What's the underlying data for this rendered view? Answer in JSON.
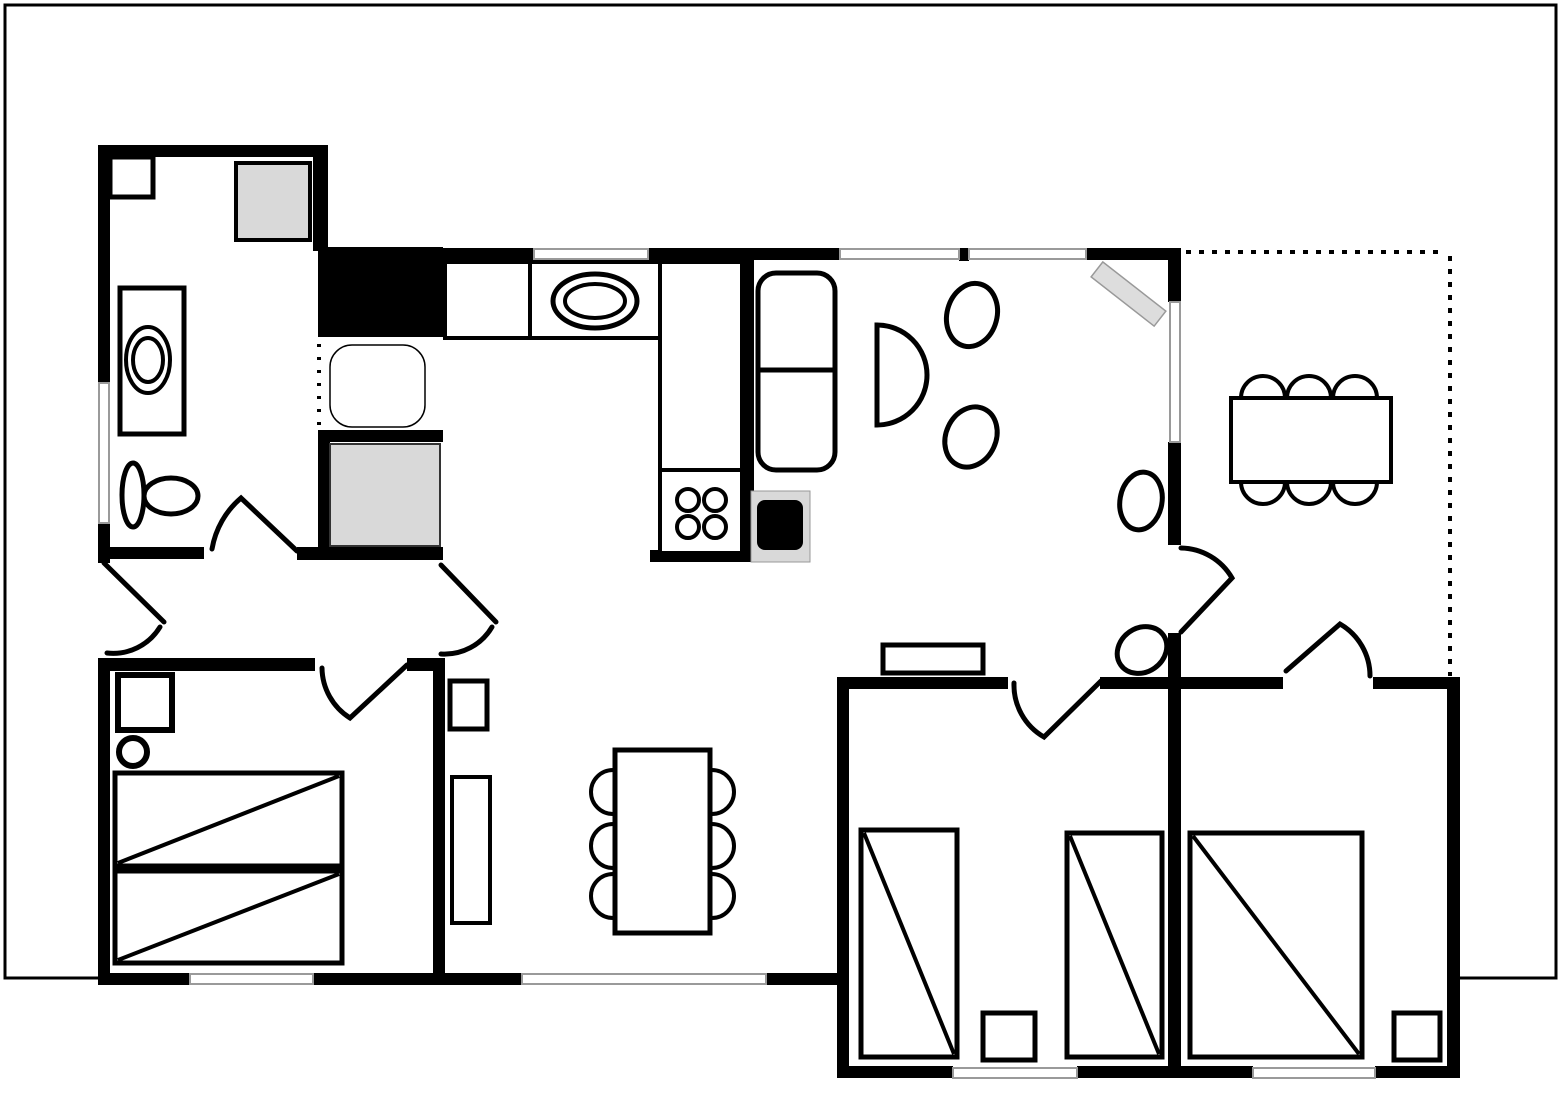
{
  "floorplan": {
    "canvas": {
      "width": 1562,
      "height": 1095,
      "background": "#ffffff"
    },
    "colors": {
      "wall": "#000000",
      "window": "#9a9a9a",
      "appliance_gray": "#d9d9d9",
      "shelf_gray": "#dddddd"
    },
    "frame": {
      "x": 5,
      "y": 5,
      "w": 1551,
      "h": 973,
      "stroke": 3
    },
    "rooms": [
      "bathroom",
      "kitchen",
      "living-room",
      "hall",
      "terrace",
      "bedroom-1",
      "bedroom-2",
      "bedroom-3"
    ],
    "interiors": [
      [
        849,
        689,
        598,
        377
      ]
    ],
    "walls": [
      [
        98,
        145,
        230,
        12
      ],
      [
        98,
        145,
        12,
        240
      ],
      [
        98,
        523,
        12,
        40
      ],
      [
        313,
        145,
        15,
        106
      ],
      [
        98,
        547,
        106,
        12
      ],
      [
        297,
        547,
        146,
        13
      ],
      [
        318,
        247,
        125,
        90
      ],
      [
        318,
        430,
        125,
        12
      ],
      [
        318,
        430,
        12,
        130
      ],
      [
        435,
        248,
        99,
        12
      ],
      [
        648,
        248,
        192,
        12
      ],
      [
        959,
        248,
        10,
        13
      ],
      [
        1086,
        248,
        95,
        12
      ],
      [
        1168,
        250,
        13,
        52
      ],
      [
        1168,
        442,
        13,
        103
      ],
      [
        1168,
        633,
        13,
        45
      ],
      [
        742,
        250,
        12,
        312
      ],
      [
        650,
        550,
        104,
        12
      ],
      [
        98,
        658,
        217,
        13
      ],
      [
        407,
        658,
        38,
        13
      ],
      [
        98,
        658,
        12,
        327
      ],
      [
        433,
        658,
        12,
        327
      ],
      [
        98,
        973,
        92,
        12
      ],
      [
        313,
        973,
        132,
        12
      ],
      [
        445,
        973,
        77,
        12
      ],
      [
        766,
        973,
        82,
        12
      ],
      [
        837,
        677,
        12,
        401
      ],
      [
        837,
        677,
        171,
        12
      ],
      [
        1100,
        677,
        80,
        12
      ],
      [
        1168,
        677,
        13,
        401
      ],
      [
        849,
        1066,
        104,
        12
      ],
      [
        1077,
        1066,
        91,
        12
      ],
      [
        1181,
        677,
        102,
        12
      ],
      [
        1373,
        677,
        87,
        12
      ],
      [
        1447,
        677,
        13,
        401
      ],
      [
        1181,
        1066,
        72,
        12
      ],
      [
        1375,
        1066,
        85,
        12
      ]
    ],
    "windows": [
      [
        534,
        249,
        114,
        10
      ],
      [
        840,
        249,
        119,
        10
      ],
      [
        969,
        249,
        117,
        10
      ],
      [
        99,
        383,
        10,
        140
      ],
      [
        1170,
        302,
        10,
        140
      ],
      [
        190,
        974,
        123,
        10
      ],
      [
        522,
        974,
        244,
        10
      ],
      [
        953,
        1068,
        124,
        10
      ],
      [
        1253,
        1068,
        122,
        10
      ]
    ],
    "dotted_lines": [
      {
        "name": "terrace-boundary-top",
        "d": "M1186,252 L1446,252",
        "w": 4,
        "dash": "5 8"
      },
      {
        "name": "terrace-boundary-right",
        "d": "M1450,256 L1450,676",
        "w": 4,
        "dash": "5 8"
      },
      {
        "name": "sink-open-edge",
        "d": "M319,344 L319,428",
        "w": 4,
        "dash": "3 10"
      }
    ],
    "doors": [
      {
        "name": "bathroom-door",
        "d": "M212,549 A86 86 0 0 1 241,498 L297,551"
      },
      {
        "name": "entrance-door",
        "d": "M104,563 L164,622 M160,627 A55 55 0 0 1 107,653"
      },
      {
        "name": "hall-passage-door",
        "d": "M441,565 L496,622 M492,627 A55 55 0 0 1 441,654"
      },
      {
        "name": "bedroom1-door",
        "d": "M322,668 A60 60 0 0 0 350,718 L407,665"
      },
      {
        "name": "bedroom2-door",
        "d": "M1014,683 A60 60 0 0 0 1044,737 L1101,681"
      },
      {
        "name": "bedroom3-door",
        "d": "M1286,671 L1340,624 A60 60 0 0 1 1370,676"
      },
      {
        "name": "living-terrace-door",
        "d": "M1181,548 A60 60 0 0 1 1232,578 L1181,632"
      }
    ],
    "furniture": [
      {
        "name": "bathroom-cabinet",
        "room": "bathroom",
        "shapes": [
          {
            "t": "rect",
            "x": 110,
            "y": 157,
            "w": 43,
            "h": 40,
            "f": "#fff",
            "s": 5
          }
        ]
      },
      {
        "name": "shower",
        "room": "bathroom",
        "shapes": [
          {
            "t": "rect",
            "x": 236,
            "y": 163,
            "w": 74,
            "h": 77,
            "f": "#d9d9d9",
            "s": 4
          }
        ]
      },
      {
        "name": "washing-machine",
        "room": "bathroom",
        "shapes": [
          {
            "t": "rect",
            "x": 120,
            "y": 288,
            "w": 64,
            "h": 146,
            "f": "#fff",
            "s": 5
          },
          {
            "t": "ellipse",
            "cx": 148,
            "cy": 360,
            "rx": 22,
            "ry": 33,
            "s": 4
          },
          {
            "t": "ellipse",
            "cx": 148,
            "cy": 360,
            "rx": 15,
            "ry": 22,
            "s": 4
          }
        ]
      },
      {
        "name": "toilet",
        "room": "bathroom",
        "shapes": [
          {
            "t": "ellipse",
            "cx": 133,
            "cy": 495,
            "rx": 11,
            "ry": 32,
            "f": "#fff",
            "s": 5
          },
          {
            "t": "ellipse",
            "cx": 171,
            "cy": 496,
            "rx": 27,
            "ry": 18,
            "f": "#fff",
            "s": 5
          }
        ]
      },
      {
        "name": "kitchen-sink",
        "room": "kitchen",
        "shapes": [
          {
            "t": "rect",
            "x": 330,
            "y": 345,
            "w": 95,
            "h": 82,
            "rx": 22,
            "f": "#fff",
            "s": 1.5
          }
        ]
      },
      {
        "name": "kitchen-appliance",
        "room": "kitchen",
        "shapes": [
          {
            "t": "rect",
            "x": 330,
            "y": 444,
            "w": 110,
            "h": 102,
            "f": "#d9d9d9",
            "s": 2,
            "c": "#333"
          }
        ]
      },
      {
        "name": "kitchen-counter",
        "room": "kitchen",
        "shapes": [
          {
            "t": "rect",
            "x": 445,
            "y": 262,
            "w": 85,
            "h": 76,
            "f": "#fff",
            "s": 4
          },
          {
            "t": "rect",
            "x": 530,
            "y": 262,
            "w": 130,
            "h": 76,
            "f": "#fff",
            "s": 4
          },
          {
            "t": "ellipse",
            "cx": 595,
            "cy": 301,
            "rx": 42,
            "ry": 27,
            "s": 5
          },
          {
            "t": "ellipse",
            "cx": 595,
            "cy": 301,
            "rx": 30,
            "ry": 17,
            "s": 4
          }
        ]
      },
      {
        "name": "kitchen-counter-column",
        "room": "kitchen",
        "shapes": [
          {
            "t": "rect",
            "x": 660,
            "y": 262,
            "w": 82,
            "h": 208,
            "f": "#fff",
            "s": 4
          }
        ]
      },
      {
        "name": "stove",
        "room": "kitchen",
        "shapes": [
          {
            "t": "rect",
            "x": 660,
            "y": 470,
            "w": 82,
            "h": 83,
            "f": "#fff",
            "s": 4
          },
          {
            "t": "circle",
            "cx": 688,
            "cy": 500,
            "r": 11,
            "s": 4
          },
          {
            "t": "circle",
            "cx": 715,
            "cy": 500,
            "r": 11,
            "s": 4
          },
          {
            "t": "circle",
            "cx": 688,
            "cy": 527,
            "r": 11,
            "s": 4
          },
          {
            "t": "circle",
            "cx": 715,
            "cy": 527,
            "r": 11,
            "s": 4
          }
        ]
      },
      {
        "name": "sofa",
        "room": "living-room",
        "shapes": [
          {
            "t": "rect",
            "x": 758,
            "y": 273,
            "w": 77,
            "h": 197,
            "rx": 18,
            "f": "#fff",
            "s": 5
          },
          {
            "t": "line",
            "x1": 758,
            "y1": 370,
            "x2": 835,
            "y2": 370,
            "s": 5
          }
        ]
      },
      {
        "name": "tv-unit",
        "room": "living-room",
        "shapes": [
          {
            "t": "rect",
            "x": 751,
            "y": 491,
            "w": 59,
            "h": 71,
            "f": "#d9d9d9",
            "s": 1,
            "c": "#999"
          },
          {
            "t": "rect",
            "x": 757,
            "y": 500,
            "w": 46,
            "h": 50,
            "rx": 8,
            "f": "#000",
            "s": 0
          }
        ]
      },
      {
        "name": "half-round-table",
        "room": "living-room",
        "shapes": [
          {
            "t": "path",
            "d": "M877,325 A50 50 0 0 1 877,425 Z",
            "f": "#fff",
            "s": 5
          }
        ]
      },
      {
        "name": "armchair-1",
        "room": "living-room",
        "shapes": [
          {
            "t": "ellipse",
            "cx": 972,
            "cy": 315,
            "rx": 25,
            "ry": 32,
            "f": "#fff",
            "s": 5,
            "rot": [
              15,
              972,
              315
            ]
          }
        ]
      },
      {
        "name": "armchair-2",
        "room": "living-room",
        "shapes": [
          {
            "t": "ellipse",
            "cx": 971,
            "cy": 437,
            "rx": 25,
            "ry": 31,
            "f": "#fff",
            "s": 5,
            "rot": [
              25,
              971,
              437
            ]
          }
        ]
      },
      {
        "name": "wall-shelf-diagonal",
        "room": "living-room",
        "shapes": [
          {
            "t": "rect",
            "x": 1089,
            "y": 284,
            "w": 80,
            "h": 19,
            "f": "#ddd",
            "s": 1.5,
            "c": "#999",
            "rot": [
              38,
              1128,
              293
            ]
          }
        ]
      },
      {
        "name": "chair-by-terrace-door",
        "room": "living-room",
        "shapes": [
          {
            "t": "ellipse",
            "cx": 1141,
            "cy": 501,
            "rx": 21,
            "ry": 29,
            "f": "#fff",
            "s": 5,
            "rot": [
              10,
              1141,
              501
            ]
          }
        ]
      },
      {
        "name": "chair-by-bedroom2",
        "room": "living-room",
        "shapes": [
          {
            "t": "ellipse",
            "cx": 1142,
            "cy": 650,
            "rx": 26,
            "ry": 22,
            "f": "#fff",
            "s": 5,
            "rot": [
              -35,
              1142,
              650
            ]
          }
        ]
      },
      {
        "name": "sideboard",
        "room": "living-room",
        "shapes": [
          {
            "t": "rect",
            "x": 883,
            "y": 645,
            "w": 100,
            "h": 28,
            "f": "#fff",
            "s": 5
          }
        ]
      },
      {
        "name": "hall-shelf",
        "room": "hall",
        "shapes": [
          {
            "t": "rect",
            "x": 450,
            "y": 681,
            "w": 37,
            "h": 48,
            "f": "#fff",
            "s": 5
          }
        ]
      },
      {
        "name": "hall-cabinet",
        "room": "hall",
        "shapes": [
          {
            "t": "rect",
            "x": 452,
            "y": 777,
            "w": 38,
            "h": 146,
            "f": "#fff",
            "s": 4
          }
        ]
      },
      {
        "name": "dining-table",
        "room": "hall",
        "shapes": [
          {
            "t": "rect",
            "x": 615,
            "y": 750,
            "w": 95,
            "h": 183,
            "f": "#fff",
            "s": 5
          },
          {
            "t": "path",
            "d": "M613,770 A22 22 0 0 0 613,814",
            "s": 4
          },
          {
            "t": "path",
            "d": "M613,824 A22 22 0 0 0 613,868",
            "s": 4
          },
          {
            "t": "path",
            "d": "M613,874 A22 22 0 0 0 613,918",
            "s": 4
          },
          {
            "t": "path",
            "d": "M712,770 A22 22 0 0 1 712,814",
            "s": 4
          },
          {
            "t": "path",
            "d": "M712,824 A22 22 0 0 1 712,868",
            "s": 4
          },
          {
            "t": "path",
            "d": "M712,874 A22 22 0 0 1 712,918",
            "s": 4
          }
        ]
      },
      {
        "name": "terrace-table",
        "room": "terrace",
        "shapes": [
          {
            "t": "rect",
            "x": 1231,
            "y": 398,
            "w": 160,
            "h": 84,
            "f": "#fff",
            "s": 4
          },
          {
            "t": "path",
            "d": "M1241,398 A22 22 0 0 1 1285,398",
            "s": 4
          },
          {
            "t": "path",
            "d": "M1287,398 A22 22 0 0 1 1331,398",
            "s": 4
          },
          {
            "t": "path",
            "d": "M1333,398 A22 22 0 0 1 1377,398",
            "s": 4
          },
          {
            "t": "path",
            "d": "M1241,482 A22 22 0 0 0 1285,482",
            "s": 4
          },
          {
            "t": "path",
            "d": "M1287,482 A22 22 0 0 0 1331,482",
            "s": 4
          },
          {
            "t": "path",
            "d": "M1333,482 A22 22 0 0 0 1377,482",
            "s": 4
          }
        ]
      },
      {
        "name": "double-bed",
        "room": "bedroom-1",
        "shapes": [
          {
            "t": "rect",
            "x": 115,
            "y": 773,
            "w": 227,
            "h": 93,
            "f": "#fff",
            "s": 5
          },
          {
            "t": "line",
            "x1": 118,
            "y1": 863,
            "x2": 339,
            "y2": 776,
            "s": 4
          },
          {
            "t": "rect",
            "x": 115,
            "y": 871,
            "w": 227,
            "h": 92,
            "f": "#fff",
            "s": 5
          },
          {
            "t": "line",
            "x1": 118,
            "y1": 960,
            "x2": 339,
            "y2": 874,
            "s": 4
          }
        ]
      },
      {
        "name": "nightstand",
        "room": "bedroom-1",
        "shapes": [
          {
            "t": "rect",
            "x": 118,
            "y": 675,
            "w": 54,
            "h": 55,
            "f": "#fff",
            "s": 6
          }
        ]
      },
      {
        "name": "stool",
        "room": "bedroom-1",
        "shapes": [
          {
            "t": "circle",
            "cx": 133,
            "cy": 752,
            "r": 14,
            "f": "#fff",
            "s": 6
          }
        ]
      },
      {
        "name": "single-bed-1",
        "room": "bedroom-2",
        "shapes": [
          {
            "t": "rect",
            "x": 861,
            "y": 830,
            "w": 96,
            "h": 227,
            "f": "#fff",
            "s": 5
          },
          {
            "t": "line",
            "x1": 864,
            "y1": 833,
            "x2": 954,
            "y2": 1054,
            "s": 4
          }
        ]
      },
      {
        "name": "single-bed-2",
        "room": "bedroom-2",
        "shapes": [
          {
            "t": "rect",
            "x": 1067,
            "y": 833,
            "w": 95,
            "h": 224,
            "f": "#fff",
            "s": 5
          },
          {
            "t": "line",
            "x1": 1070,
            "y1": 836,
            "x2": 1159,
            "y2": 1054,
            "s": 4
          }
        ]
      },
      {
        "name": "nightstand",
        "room": "bedroom-2",
        "shapes": [
          {
            "t": "rect",
            "x": 983,
            "y": 1013,
            "w": 52,
            "h": 47,
            "f": "#fff",
            "s": 5
          }
        ]
      },
      {
        "name": "double-bed",
        "room": "bedroom-3",
        "shapes": [
          {
            "t": "rect",
            "x": 1190,
            "y": 833,
            "w": 172,
            "h": 224,
            "f": "#fff",
            "s": 5
          },
          {
            "t": "line",
            "x1": 1193,
            "y1": 836,
            "x2": 1359,
            "y2": 1054,
            "s": 4
          }
        ]
      },
      {
        "name": "nightstand",
        "room": "bedroom-3",
        "shapes": [
          {
            "t": "rect",
            "x": 1394,
            "y": 1013,
            "w": 46,
            "h": 47,
            "f": "#fff",
            "s": 5
          }
        ]
      }
    ]
  }
}
